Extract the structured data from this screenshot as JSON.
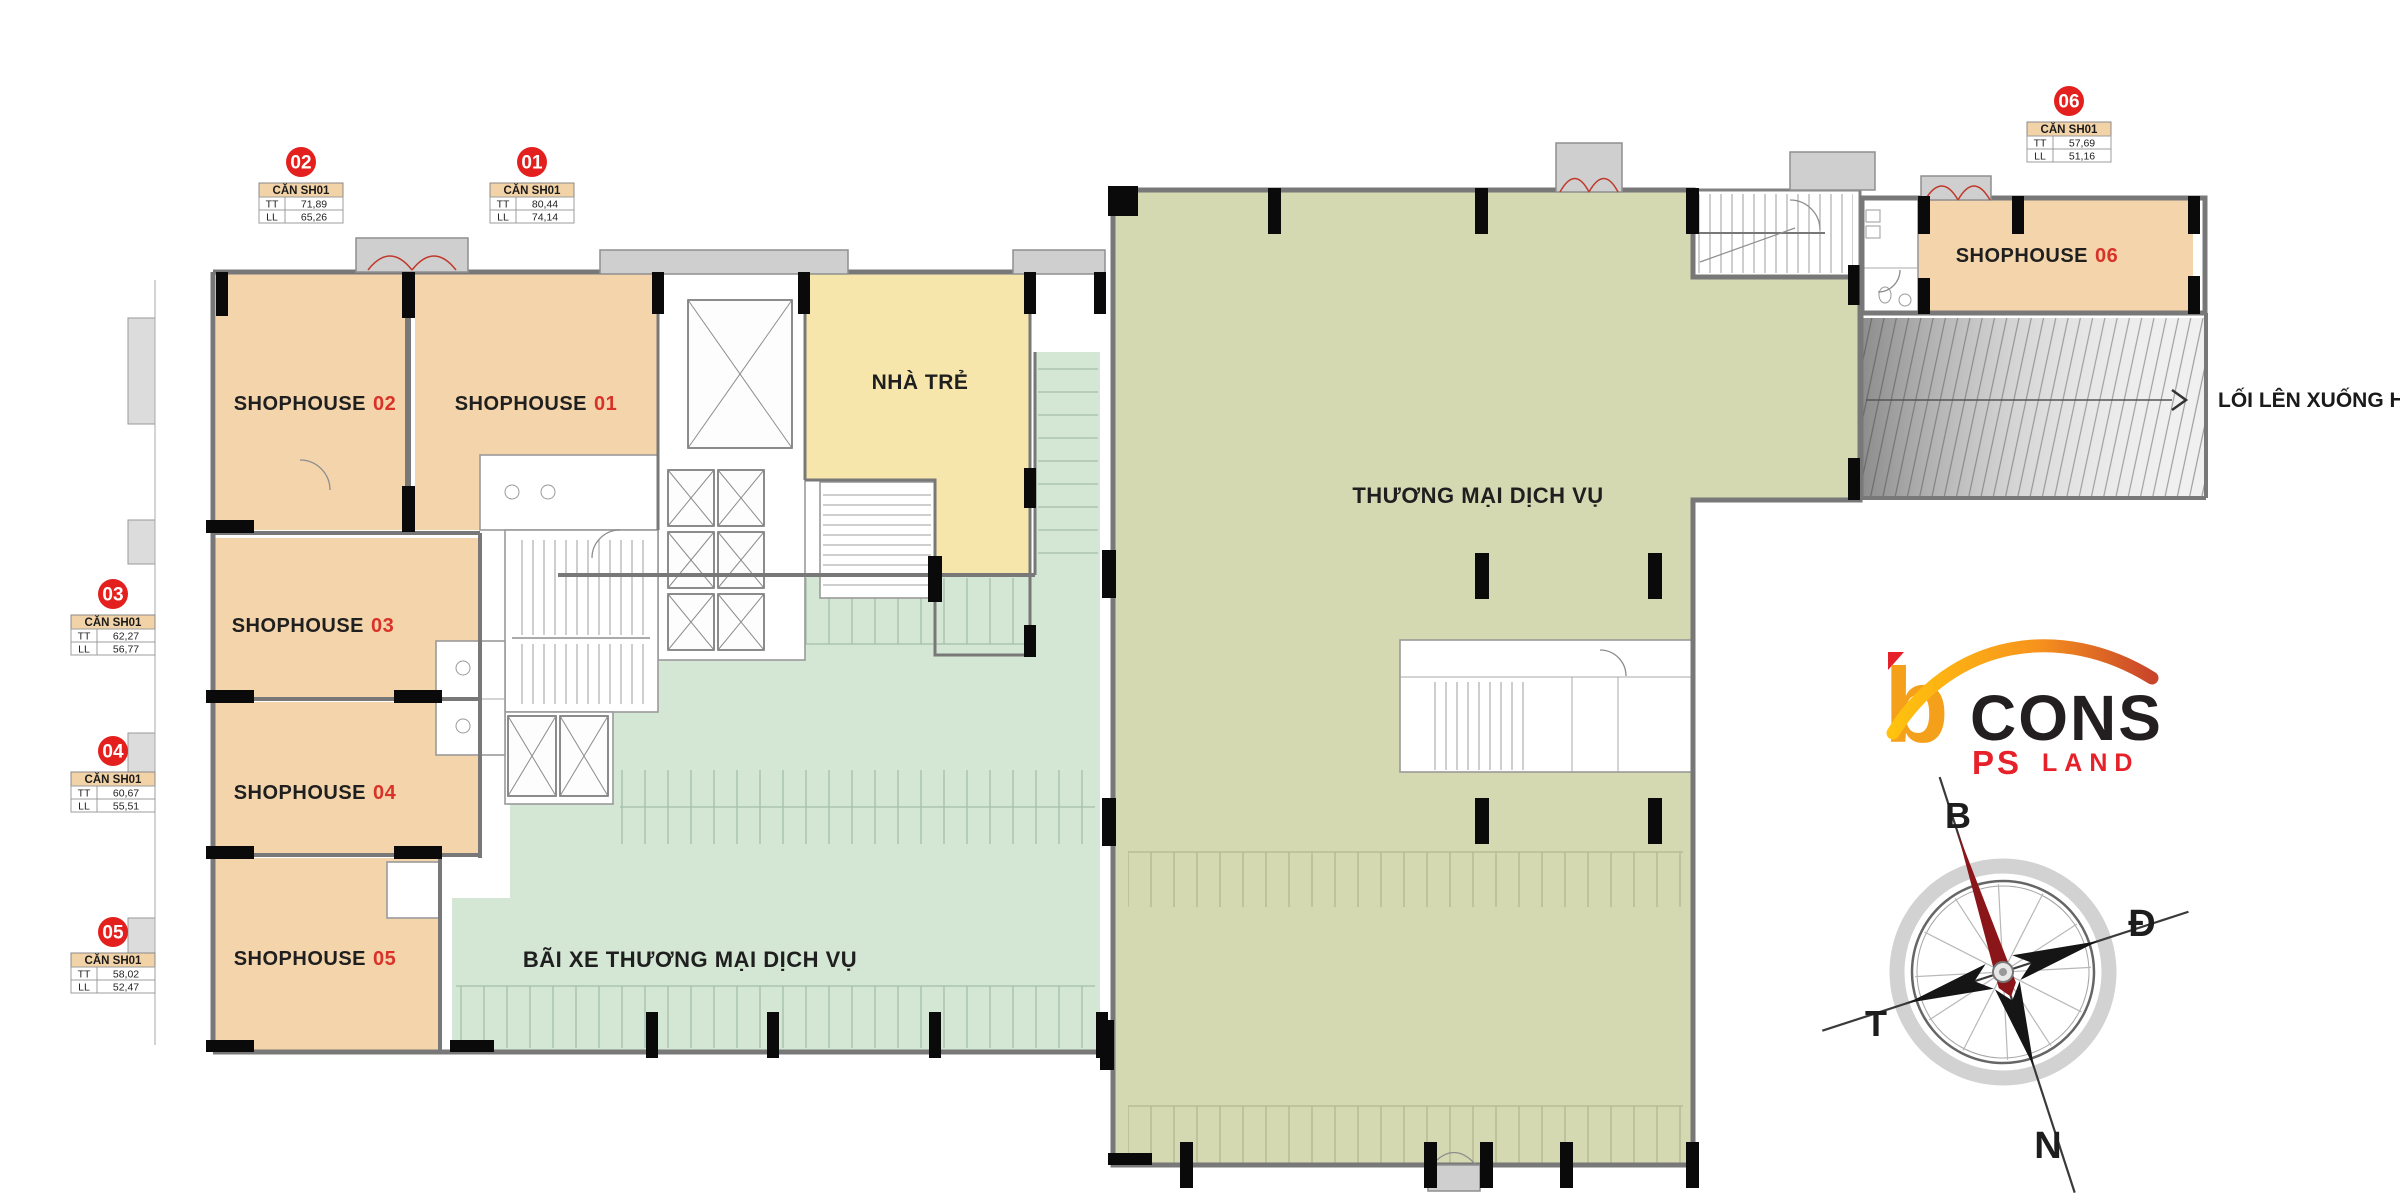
{
  "plan": {
    "units": [
      {
        "badge": "01",
        "title": "CĂN SH01",
        "rows": [
          [
            "TT",
            "80,44"
          ],
          [
            "LL",
            "74,14"
          ]
        ],
        "name": "SHOPHOUSE",
        "num": "01"
      },
      {
        "badge": "02",
        "title": "CĂN SH01",
        "rows": [
          [
            "TT",
            "71,89"
          ],
          [
            "LL",
            "65,26"
          ]
        ],
        "name": "SHOPHOUSE",
        "num": "02"
      },
      {
        "badge": "03",
        "title": "CĂN SH01",
        "rows": [
          [
            "TT",
            "62,27"
          ],
          [
            "LL",
            "56,77"
          ]
        ],
        "name": "SHOPHOUSE",
        "num": "03"
      },
      {
        "badge": "04",
        "title": "CĂN SH01",
        "rows": [
          [
            "TT",
            "60,67"
          ],
          [
            "LL",
            "55,51"
          ]
        ],
        "name": "SHOPHOUSE",
        "num": "04"
      },
      {
        "badge": "05",
        "title": "CĂN SH01",
        "rows": [
          [
            "TT",
            "58,02"
          ],
          [
            "LL",
            "52,47"
          ]
        ],
        "name": "SHOPHOUSE",
        "num": "05"
      },
      {
        "badge": "06",
        "title": "CĂN SH01",
        "rows": [
          [
            "TT",
            "57,69"
          ],
          [
            "LL",
            "51,16"
          ]
        ],
        "name": "SHOPHOUSE",
        "num": "06"
      }
    ],
    "regions": {
      "daycare": "NHÀ TRẺ",
      "commercial": "THƯƠNG MẠI DỊCH VỤ",
      "parking": "BÃI XE THƯƠNG MẠI DỊCH VỤ",
      "ramp": "LỐI LÊN XUỐNG HẦM"
    },
    "compass": {
      "north": "B",
      "east": "Đ",
      "west": "T",
      "south": "N"
    },
    "logo": {
      "b": "b",
      "cons": "CONS",
      "ps": "PS",
      "land": "LAND"
    },
    "colors": {
      "shophouse": "#f3d4ab",
      "commercial": "#d5d9b2",
      "parking": "#d4e6d4",
      "daycare": "#f6e6ab",
      "badge": "#e4201f",
      "unit_red": "#d93228"
    }
  }
}
